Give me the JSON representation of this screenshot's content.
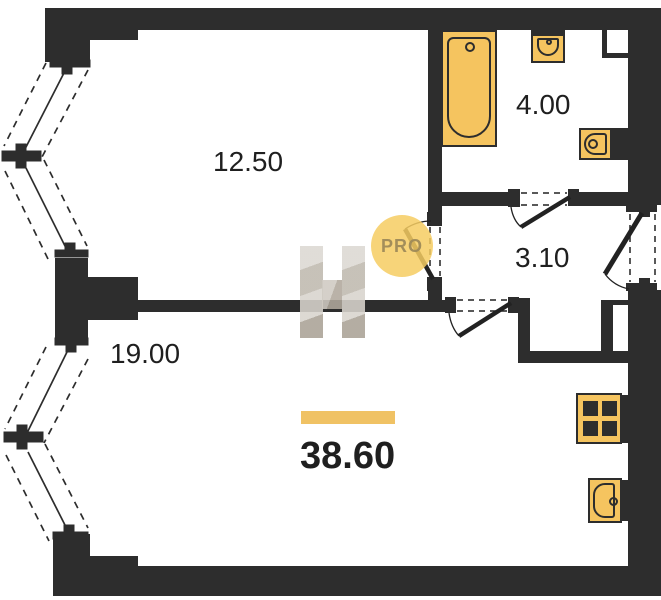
{
  "plan": {
    "rooms": [
      {
        "key": "bedroom",
        "area": "12.50"
      },
      {
        "key": "bathroom",
        "area": "4.00"
      },
      {
        "key": "hallway",
        "area": "3.10"
      },
      {
        "key": "living",
        "area": "19.00"
      }
    ],
    "total_area": "38.60",
    "fixtures": [
      "bathtub",
      "washbasin",
      "toilet",
      "stove",
      "kitchen-sink"
    ]
  },
  "watermark": {
    "logo_letter": "H",
    "badge": "PRO"
  },
  "colors": {
    "wall": "#2d2d2d",
    "fixture_fill": "#f5c45f",
    "accent_bar": "#f0c264",
    "badge_bg": "#f6cd62"
  }
}
